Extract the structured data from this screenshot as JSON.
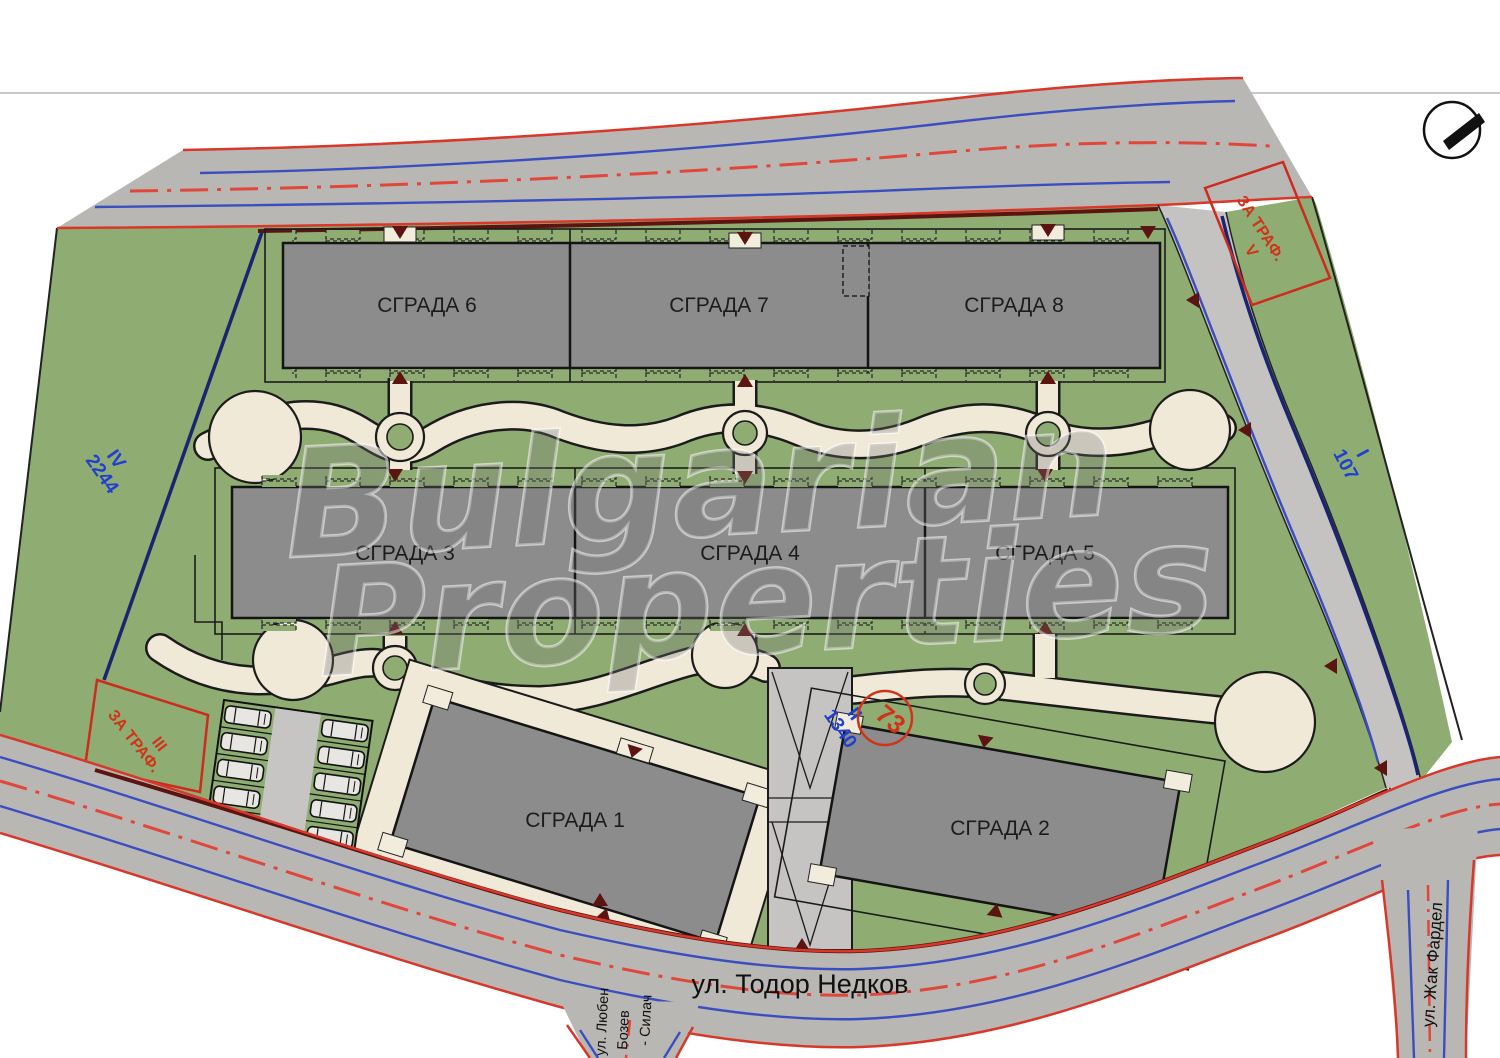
{
  "plan": {
    "buildings": [
      "СГРАДА 1",
      "СГРАДА 2",
      "СГРАДА 3",
      "СГРАДА 4",
      "СГРАДА 5",
      "СГРАДА 6",
      "СГРАДА 7",
      "СГРАДА 8"
    ],
    "streets": {
      "bottom": "ул. Тодор Недков",
      "right": "ул. Жак Фардел",
      "left_line1": "ул. Любен",
      "left_line2": "Бозев",
      "left_line3": "- Силач"
    },
    "parcels": {
      "iv": "IV",
      "iv_num": "2244",
      "i": "I",
      "i_num": "107",
      "ii": "II",
      "ii_num": "1340",
      "circle_num": "73",
      "v": "V",
      "v_label": "ЗА ТРАФ.",
      "iii": "III",
      "iii_label": "ЗА ТРАФ."
    },
    "watermark": {
      "line1": "Bulgarian",
      "line2": "Properties"
    },
    "colors": {
      "site_green": "#8fac72",
      "road_asphalt": "#b9b7b4",
      "building_gray": "#8c8c8c",
      "path_cream": "#f0e9d8",
      "edge_red": "#d8372a",
      "curb_blue": "#3a4ec0",
      "boundary_navy": "#1a2470",
      "arrow_maroon": "#5c1410",
      "label_blue": "#1f3fd0",
      "label_red": "#d03418"
    }
  }
}
